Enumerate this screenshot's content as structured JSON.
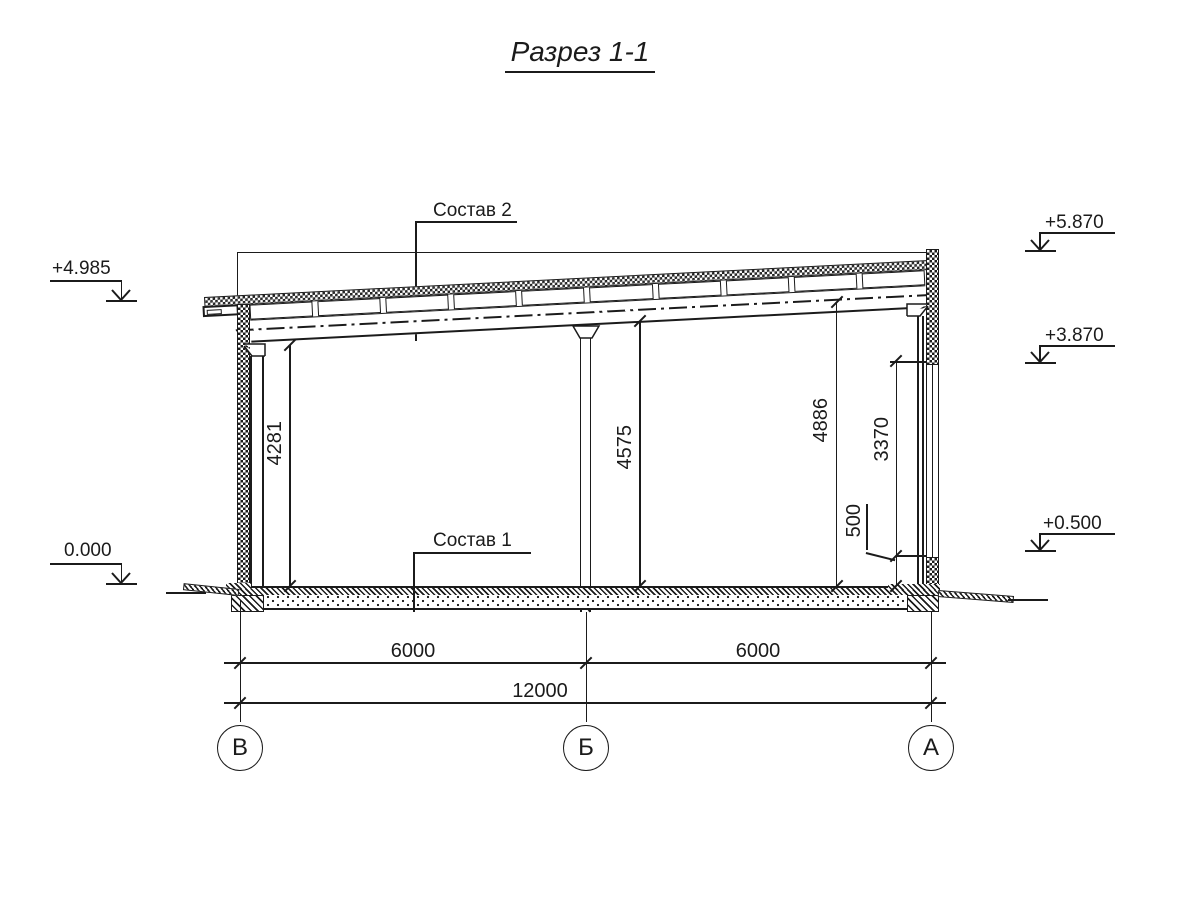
{
  "title": "Разрез 1-1",
  "labels": {
    "sostav2": "Состав 2",
    "sostav1": "Состав 1"
  },
  "elevations": {
    "left_roof": "+4.985",
    "left_zero": "0.000",
    "right_parapet": "+5.870",
    "right_window_head": "+3.870",
    "right_window_sill": "+0.500"
  },
  "dims": {
    "v_left_clear": "4281",
    "v_mid_clear": "4575",
    "v_right_axis": "4886",
    "v_window": "3370",
    "v_sill": "500",
    "h_span1": "6000",
    "h_span2": "6000",
    "h_total": "12000"
  },
  "axes": {
    "left": "В",
    "middle": "Б",
    "right": "А"
  },
  "colors": {
    "ink": "#1b1b1b",
    "paper": "#ffffff"
  }
}
